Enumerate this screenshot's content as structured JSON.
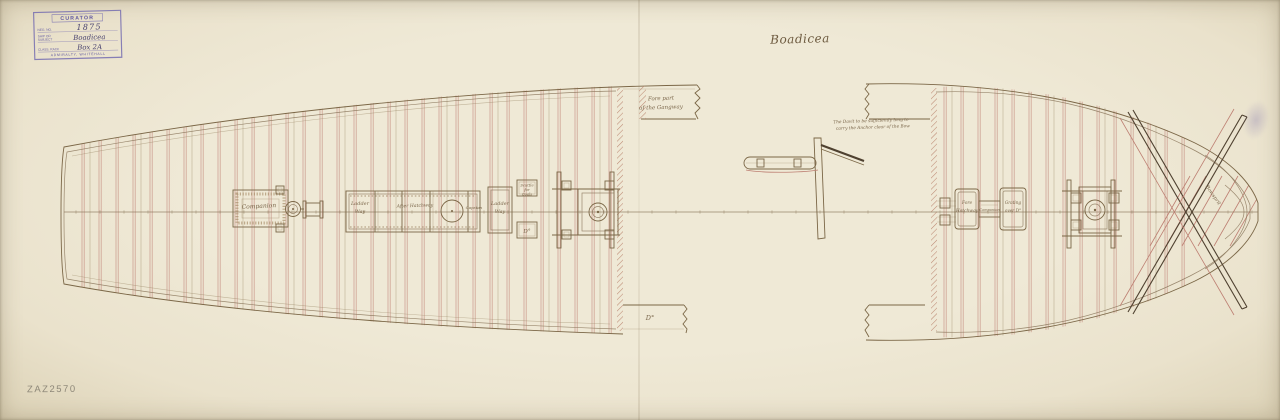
{
  "document": {
    "title": "Boadicea",
    "reference_number": "ZAZ2570"
  },
  "stamp": {
    "header": "CURATOR",
    "fields": [
      {
        "label": "Neg. No.",
        "value": "1875"
      },
      {
        "label": "Ship or Subject",
        "value": "Boadicea"
      },
      {
        "label": "Class. Rack",
        "value": "Box 2A"
      }
    ],
    "footer": "ADMIRALTY, WHITEHALL"
  },
  "plan": {
    "labels": {
      "companion": "Companion",
      "ladder_aft_1": "Ladder",
      "ladder_aft_2": "Way",
      "after_hatchway": "After Hatchway",
      "capstan": "Capstan",
      "ladder_1": "Ladder",
      "ladder_2": "Way",
      "scuttle_1": "Scuttle",
      "scuttle_2": "for",
      "scuttle_3": "Coals",
      "scuttle_ditto": "D°",
      "gangway_1": "Fore part",
      "gangway_2": "of the Gangway",
      "gangway_ditto": "D°",
      "fore_hatchway_1": "Fore",
      "fore_hatchway_2": "Hatchway",
      "fore_companion": "Companion",
      "fore_grating_1": "Grating",
      "fore_grating_2": "over D°",
      "bowsprit": "Bowsprit"
    },
    "notes": {
      "davit_1": "The Davit to be sufficiently long to",
      "davit_2": "carry the Anchor clear of the Bow"
    }
  },
  "colors": {
    "ink": "#7b6747",
    "beam_red": "#bd7f72",
    "stamp_purple": "#6f66a8",
    "paper": "#ebe4cf",
    "pencil": "#8a8476"
  }
}
